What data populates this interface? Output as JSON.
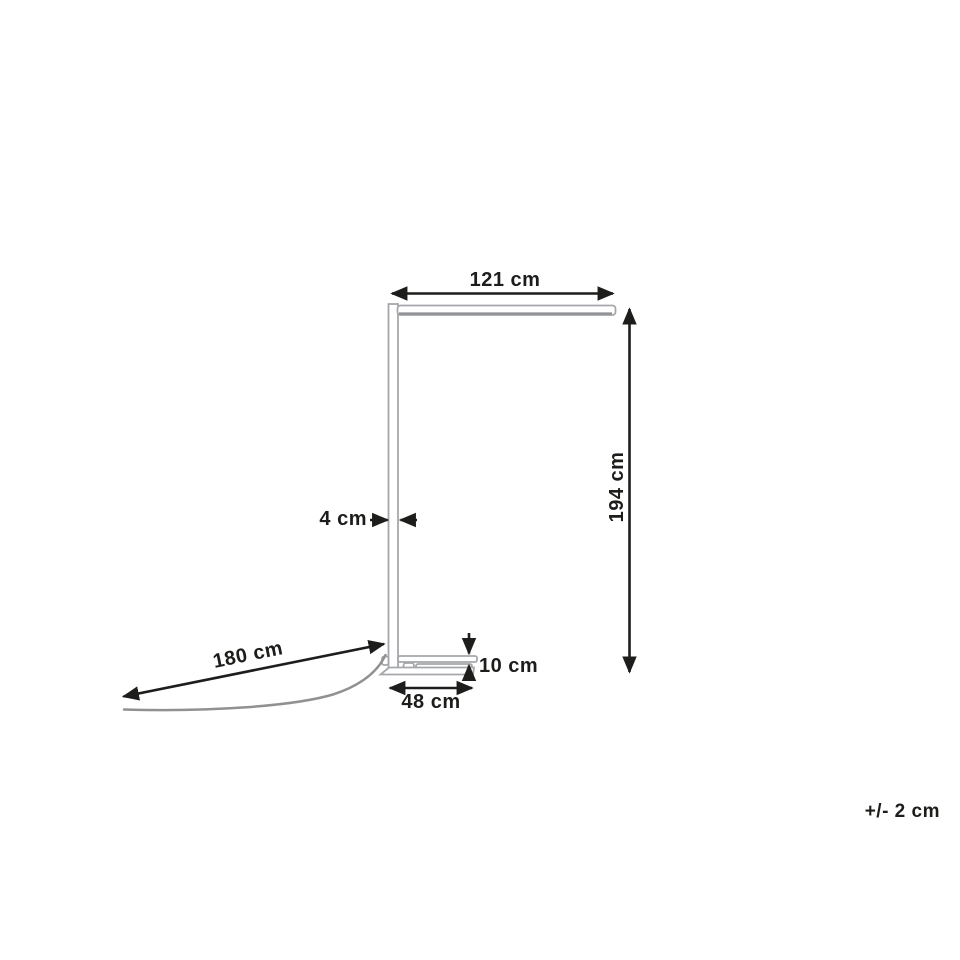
{
  "diagram": {
    "title": "floor-lamp-dimension-diagram",
    "labels": {
      "arm_width": "121 cm",
      "total_height": "194 cm",
      "pole_depth": "4 cm",
      "base_height": "10 cm",
      "base_depth": "48 cm",
      "cable_length": "180 cm",
      "tolerance": "+/- 2 cm"
    },
    "colors": {
      "dimension_ink": "#1d1d1b",
      "lamp_outline": "#a5a7aa",
      "cable": "#8f9193",
      "background": "#ffffff"
    }
  }
}
